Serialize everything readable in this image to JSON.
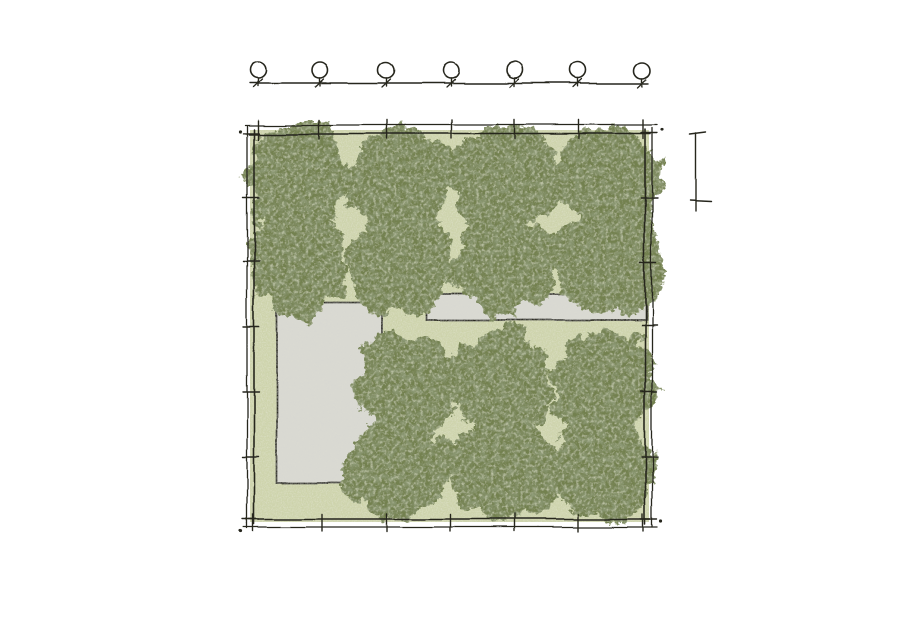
{
  "page": {
    "width": 900,
    "height": 636,
    "background": "#ffffff"
  },
  "colors": {
    "line": "#26261f",
    "grass": "#cdd3aa",
    "grass_speckle_dark": "#a9b183",
    "grass_speckle_light": "#e9ecd0",
    "canopy": "#73814f",
    "canopy_dark": "#4c5a36",
    "canopy_light": "#b7bf90",
    "paving": "#d9d9d2",
    "paving_speckle": "#b5b5aa",
    "post_fill": "#ffffff"
  },
  "site": {
    "lawn": {
      "x": 250,
      "y": 130,
      "w": 399,
      "h": 392
    },
    "boundary": {
      "x": 254,
      "y": 134,
      "w": 391,
      "h": 385,
      "overshoot": 5
    },
    "outer_band": {
      "left_x": 247,
      "right_x": 652,
      "top_y": 125,
      "bottom_y": 527,
      "top_x1": 245,
      "top_x2": 657,
      "bottom_x1": 244,
      "bottom_x2": 657,
      "left_y1": 126,
      "left_y2": 528,
      "right_y1": 128,
      "right_y2": 527
    },
    "ticks": {
      "top_x": [
        258,
        320,
        387,
        451,
        515,
        579,
        643
      ],
      "bottom_x": [
        253,
        322,
        387,
        451,
        515,
        578,
        643
      ],
      "left_y": [
        133,
        198,
        262,
        327,
        392,
        457,
        519
      ],
      "right_y": [
        133,
        198,
        263,
        325,
        392,
        457,
        519
      ]
    },
    "corner_dots": [
      {
        "x": 240,
        "y": 131
      },
      {
        "x": 662,
        "y": 130
      },
      {
        "x": 661,
        "y": 521
      },
      {
        "x": 241,
        "y": 531
      }
    ],
    "paved_areas": [
      {
        "name": "paved-court",
        "x": 277,
        "y": 303,
        "w": 104,
        "h": 180
      },
      {
        "name": "paved-path",
        "x": 427,
        "y": 294,
        "w": 219,
        "h": 26
      }
    ],
    "trees": [
      {
        "cx": 297,
        "cy": 178,
        "r": 55
      },
      {
        "cx": 400,
        "cy": 177,
        "r": 54
      },
      {
        "cx": 506,
        "cy": 178,
        "r": 56
      },
      {
        "cx": 608,
        "cy": 178,
        "r": 54
      },
      {
        "cx": 297,
        "cy": 263,
        "r": 54
      },
      {
        "cx": 400,
        "cy": 263,
        "r": 55
      },
      {
        "cx": 506,
        "cy": 262,
        "r": 54
      },
      {
        "cx": 608,
        "cy": 263,
        "r": 56
      },
      {
        "cx": 407,
        "cy": 384,
        "r": 53
      },
      {
        "cx": 503,
        "cy": 384,
        "r": 55
      },
      {
        "cx": 604,
        "cy": 384,
        "r": 54
      },
      {
        "cx": 399,
        "cy": 469,
        "r": 54
      },
      {
        "cx": 503,
        "cy": 469,
        "r": 55
      },
      {
        "cx": 603,
        "cy": 467,
        "r": 54
      }
    ],
    "fence": {
      "line_y": 83,
      "x1": 250,
      "x2": 649,
      "posts_x": [
        258,
        320,
        386,
        450,
        514,
        578,
        643
      ],
      "post_cy": 70,
      "post_r": 8,
      "stem_y1": 78,
      "stem_y2": 85,
      "foot_dx1": -4.5,
      "foot_dy1": 4,
      "foot_dx2": 4,
      "foot_dy2": -4
    },
    "scale_bar": {
      "x": 696,
      "y1": 134,
      "y2": 200,
      "tail_y": 211,
      "top_tick_x1": 690,
      "top_tick_x2": 706,
      "bottom_tick_x1": 690,
      "bottom_tick_x2": 712
    }
  }
}
